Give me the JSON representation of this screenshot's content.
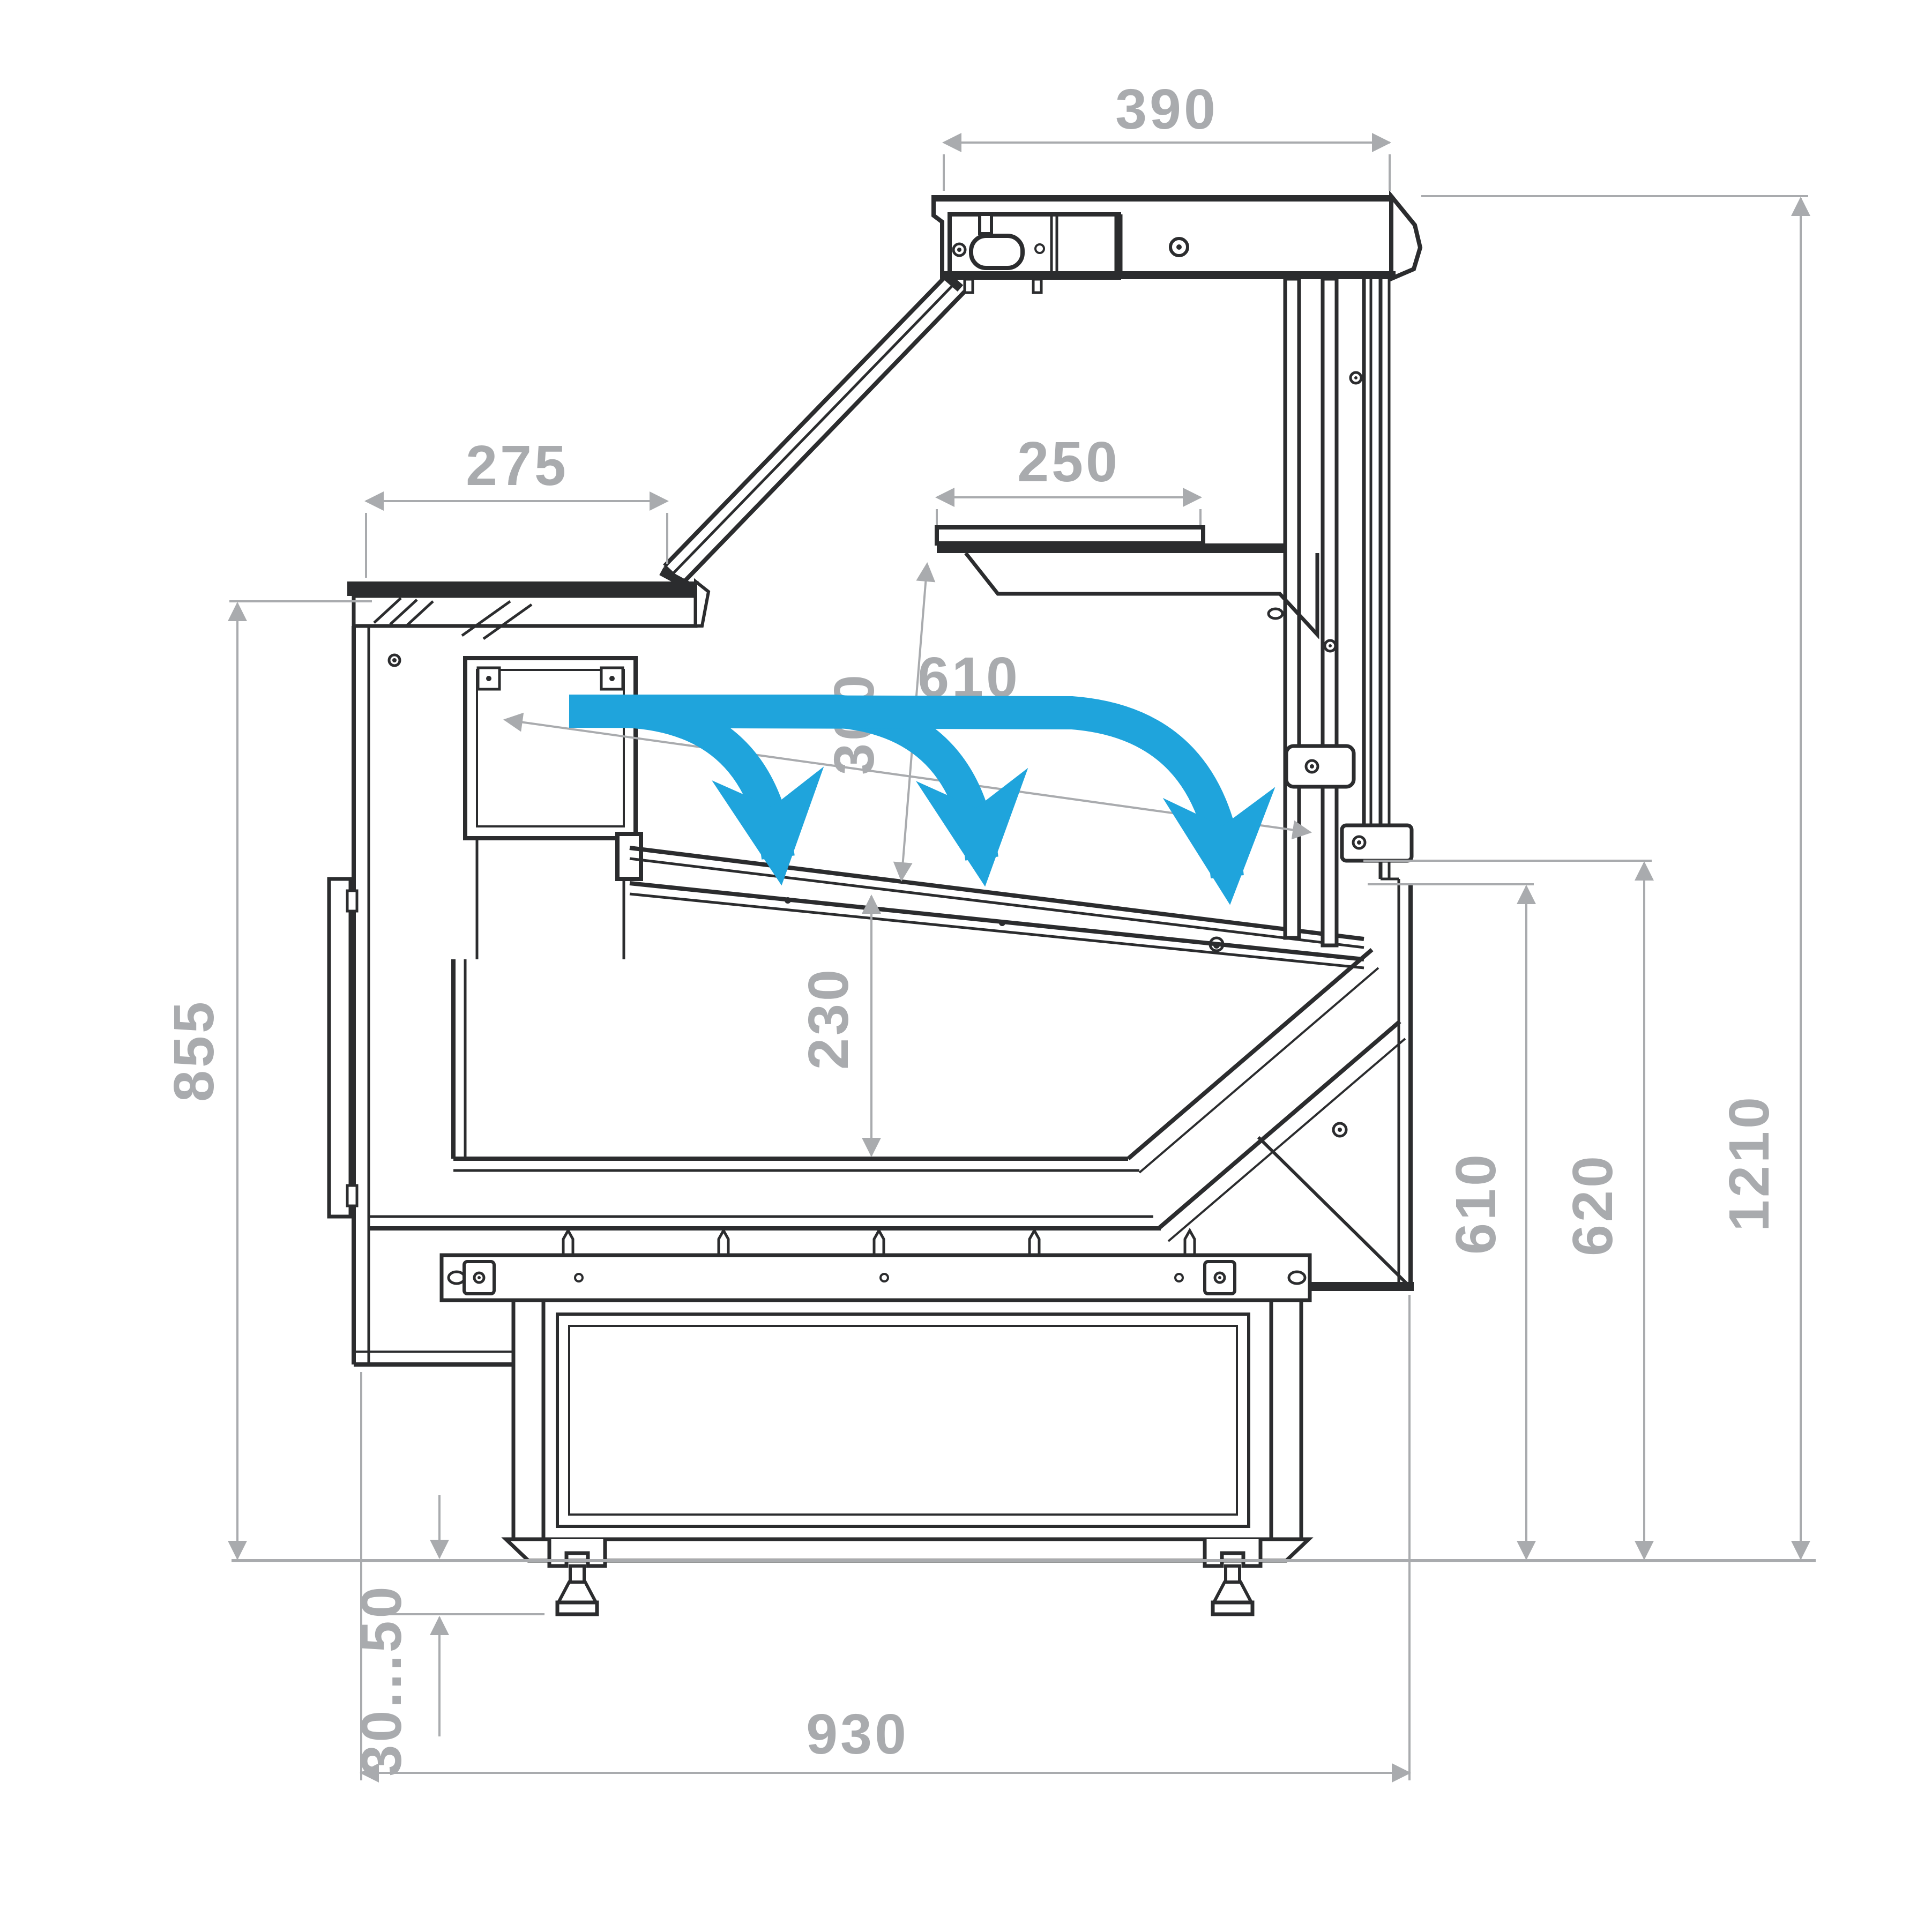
{
  "drawing": {
    "type": "technical-cross-section",
    "subject": "refrigerated serve-over display case, side section with airflow",
    "units": "mm",
    "dimensions": {
      "canopy_depth": "390",
      "front_counter_depth": "275",
      "upper_shelf_depth": "250",
      "shelf_clearance": "300",
      "display_area_depth": "610",
      "well_depth": "230",
      "counter_height": "855",
      "deck_edge_height": "610",
      "rear_ledge_height": "620",
      "overall_height": "1210",
      "leg_adjustment_range": "30...50",
      "base_footprint_depth": "930"
    },
    "colors": {
      "line": "#2b2c2e",
      "dimension": "#a9abae",
      "airflow": "#1fa4dc",
      "background": "#ffffff"
    }
  }
}
